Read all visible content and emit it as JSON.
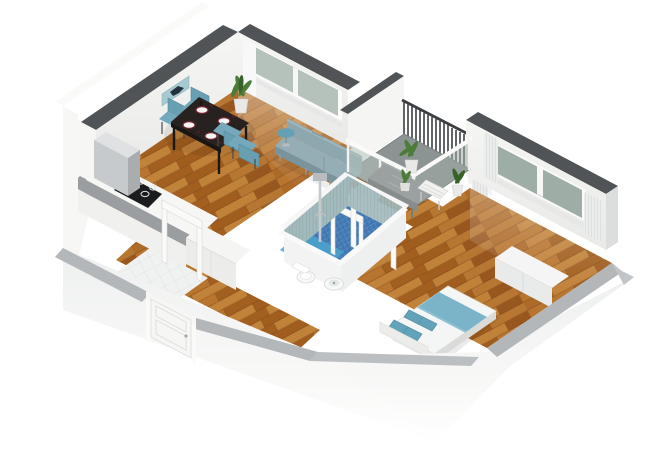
{
  "meta": {
    "title": "3D isometric cutaway floor plan — one-bedroom apartment",
    "view": "dollhouse birds-eye from south-west"
  },
  "rooms": [
    {
      "name": "living-dining room",
      "floor": "wood parquet"
    },
    {
      "name": "kitchen",
      "floor": "wood parquet"
    },
    {
      "name": "hallway",
      "floor": "wood parquet"
    },
    {
      "name": "entry room",
      "floor": "white tile"
    },
    {
      "name": "bathroom",
      "floor": "blue mosaic tile"
    },
    {
      "name": "bedroom",
      "floor": "wood parquet"
    },
    {
      "name": "balcony",
      "floor": "gray stone"
    }
  ],
  "furniture": [
    "wall picture",
    "dining table",
    "4 teal dining chairs",
    "4 white plates",
    "fridge",
    "counter with cooktop",
    "second counter",
    "open door frame",
    "sofa",
    "round side table",
    "potted plant",
    "balcony railing",
    "glass balustrade",
    "balcony stone table",
    "2 white balcony chairs",
    "3 balcony plants",
    "shower column",
    "toilet",
    "bidet",
    "double bed with teal blanket and 4 pillows",
    "low white cabinet",
    "radiator panels",
    "entrance door",
    "living-room window",
    "bedroom window",
    "curtains"
  ],
  "palette": {
    "wallTopDark": "#515456",
    "wallTopLight": "#b4b7b9",
    "wallFace": "#f2f3f1",
    "wallFaceShade": "#e7e8e6",
    "wallOuter": "#f7f7f6",
    "wood": "#b06f2e",
    "woodDark": "#7c481b",
    "balconyFloor": "#8c9393",
    "bathFloor": "#4077b2",
    "showerFloor": "#4aa4cb",
    "bathWallTile": "#a3babd",
    "entryTile": "#f0f2f2",
    "glass": "#b5c2bc",
    "glassDark": "#9fada7",
    "frameWhite": "#fafaf9",
    "curtain": "#ebecec",
    "sofa": "#8ca7ae",
    "sofaDark": "#79949c",
    "chairTeal": "#689fb2",
    "tableDark": "#272220",
    "plate": "#f6f6f5",
    "plateRim": "#7a2430",
    "bedBlanket": "#7bb4c8",
    "bedPillow": "#63a3ba",
    "bedWhite": "#f4f5f5",
    "plant": "#4c7c39",
    "plantDark": "#39622b",
    "pot": "#e9eae8",
    "railDark": "#3b3f42",
    "steel": "#c7cacc",
    "steelDark": "#aaadaf",
    "cooktop": "#1a1c1e",
    "stoneTable": "#9ba1a1",
    "artTeal": "#a7c9d1",
    "artDark": "#22333c"
  }
}
